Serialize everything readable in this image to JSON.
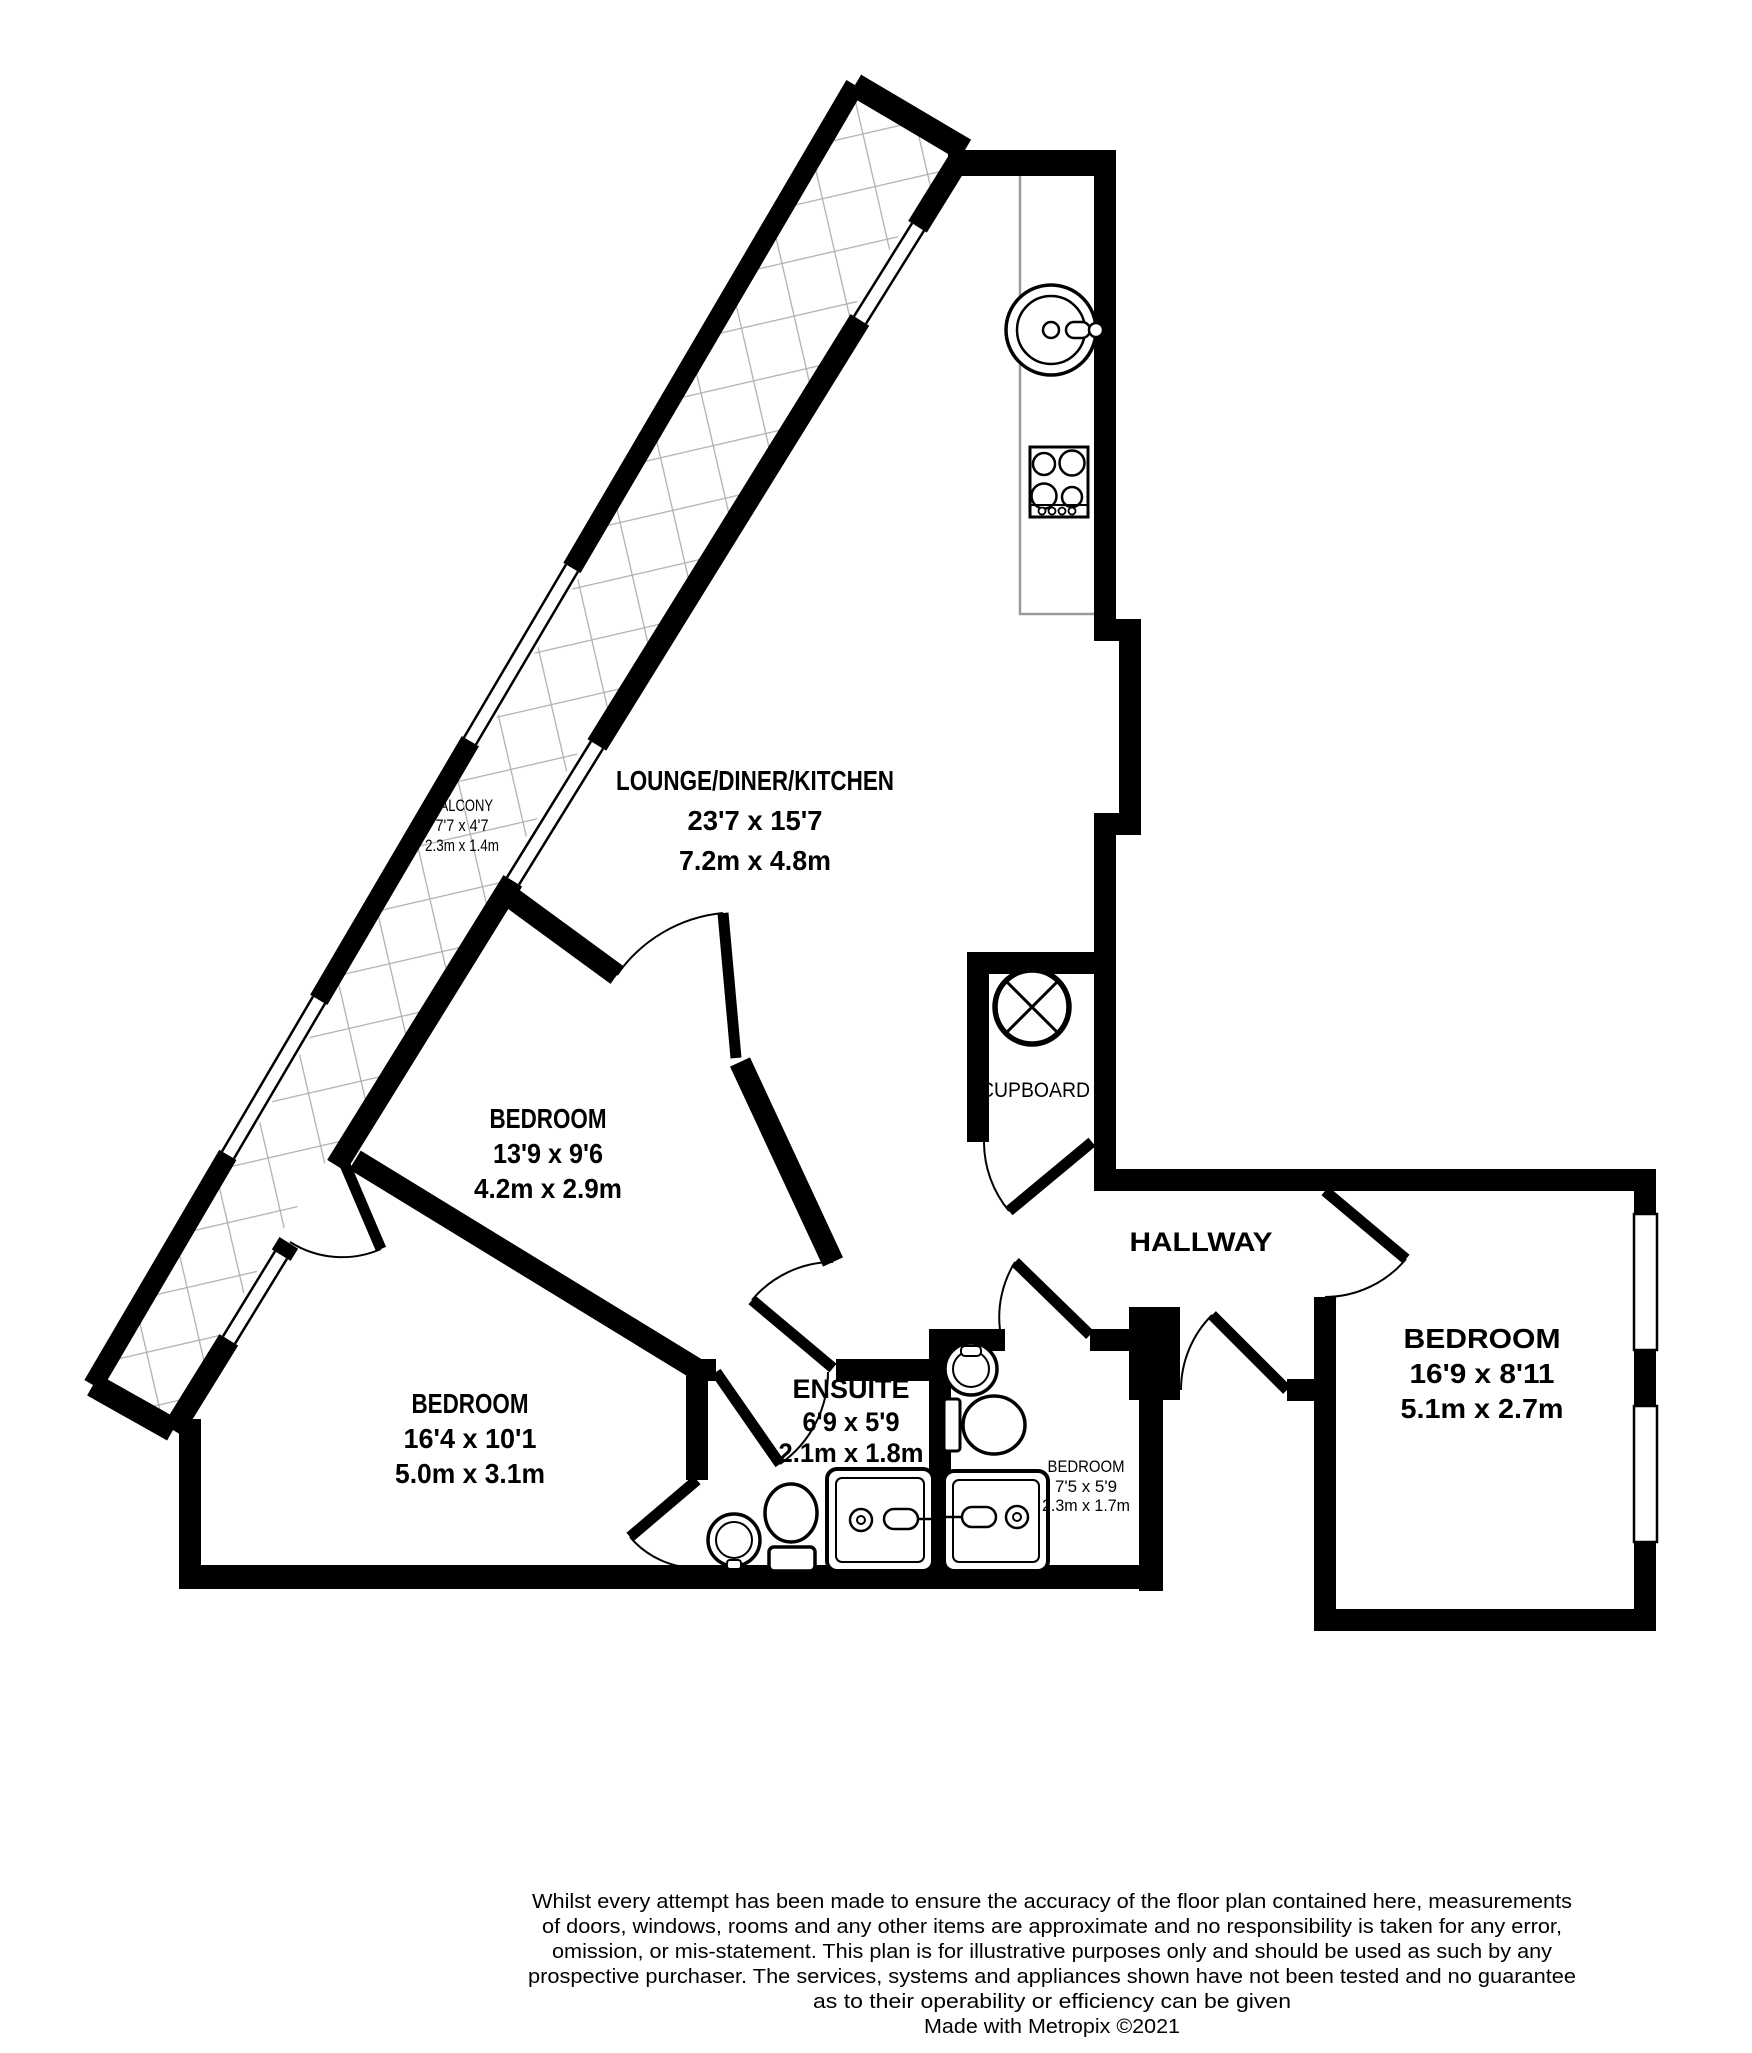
{
  "rooms": {
    "lounge": {
      "name": "LOUNGE/DINER/KITCHEN",
      "imperial": "23'7 x 15'7",
      "metric": "7.2m x 4.8m"
    },
    "bedroom_middle": {
      "name": "BEDROOM",
      "imperial": "13'9 x 9'6",
      "metric": "4.2m x 2.9m"
    },
    "bedroom_left": {
      "name": "BEDROOM",
      "imperial": "16'4 x 10'1",
      "metric": "5.0m x 3.1m"
    },
    "bedroom_right": {
      "name": "BEDROOM",
      "imperial": "16'9 x 8'11",
      "metric": "5.1m x 2.7m"
    },
    "ensuite": {
      "name": "ENSUITE",
      "imperial": "6'9 x 5'9",
      "metric": "2.1m x 1.8m"
    },
    "bathroom": {
      "name": "BEDROOM",
      "imperial": "7'5 x 5'9",
      "metric": "2.3m x 1.7m"
    },
    "balcony": {
      "name": "BALCONY",
      "imperial": "7'7 x 4'7",
      "metric": "2.3m x 1.4m"
    },
    "hallway": {
      "name": "HALLWAY"
    },
    "cupboard": {
      "name": "CUPBOARD"
    }
  },
  "footer": {
    "disclaimer_lines": [
      "Whilst every attempt has been made to ensure the accuracy of the floor plan contained here, measurements",
      "of doors, windows, rooms and any other items are approximate and no responsibility is taken for any error,",
      "omission, or mis-statement. This plan is for illustrative purposes only and should be used as such by any",
      "prospective purchaser. The services, systems and appliances shown have not been tested and no guarantee",
      "as to their operability or efficiency can be given"
    ],
    "credit": "Made with Metropix ©2021"
  },
  "colors": {
    "wall": "#000000",
    "background": "#ffffff",
    "hatch": "#b0b0b0"
  }
}
